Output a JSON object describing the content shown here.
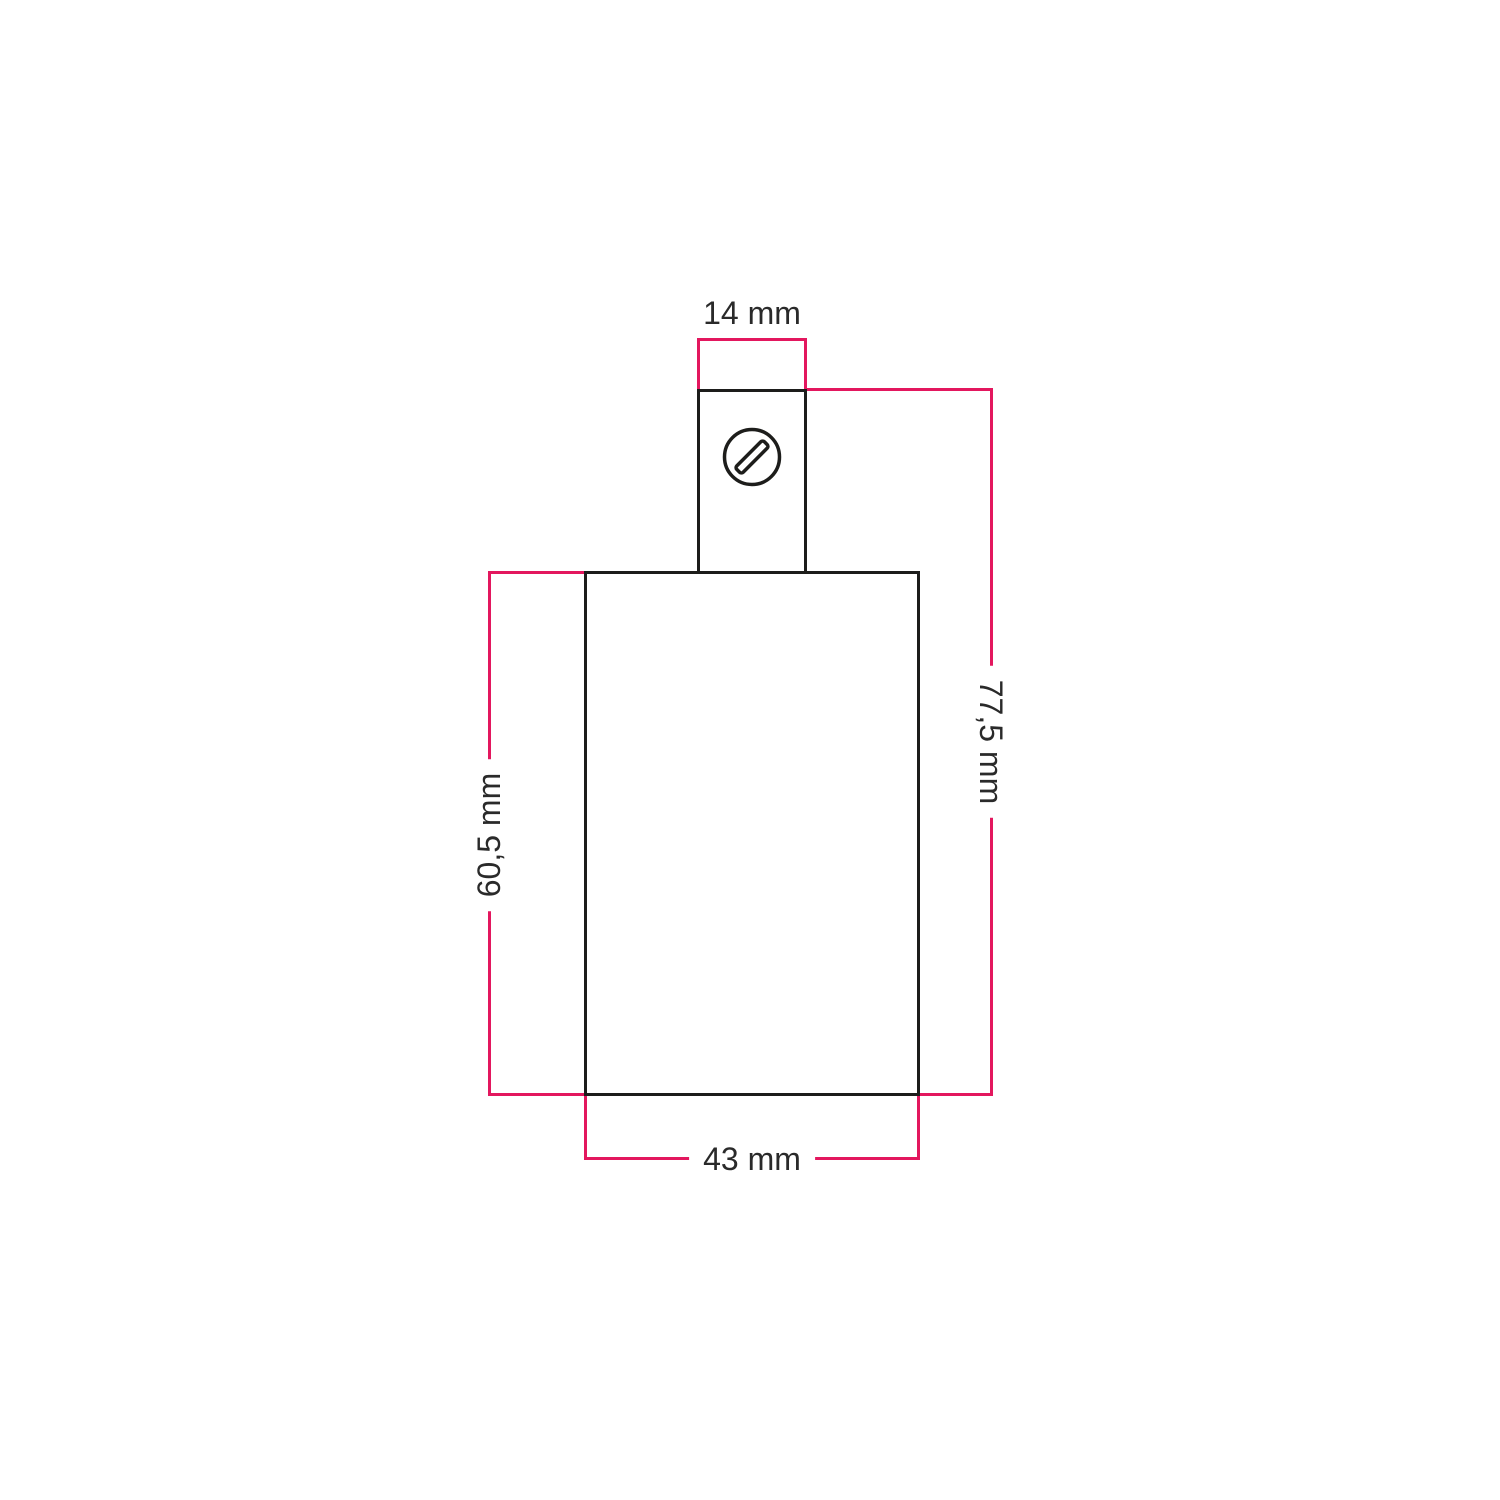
{
  "diagram": {
    "type": "technical-dimension-drawing",
    "unit": "mm",
    "colors": {
      "dimension_lines": "#e3175e",
      "outline": "#1d1d1b",
      "label_text": "#2a2a2a",
      "background": "#ffffff"
    },
    "dimensions": [
      {
        "id": "clamp-width",
        "label": "14 mm",
        "orientation": "horizontal",
        "position": "top"
      },
      {
        "id": "overall-height",
        "label": "77,5 mm",
        "orientation": "vertical",
        "position": "right"
      },
      {
        "id": "body-height",
        "label": "60,5 mm",
        "orientation": "vertical",
        "position": "left"
      },
      {
        "id": "body-width",
        "label": "43 mm",
        "orientation": "horizontal",
        "position": "bottom"
      }
    ],
    "icons": {
      "screw": "slotted-screw-head-icon"
    }
  }
}
